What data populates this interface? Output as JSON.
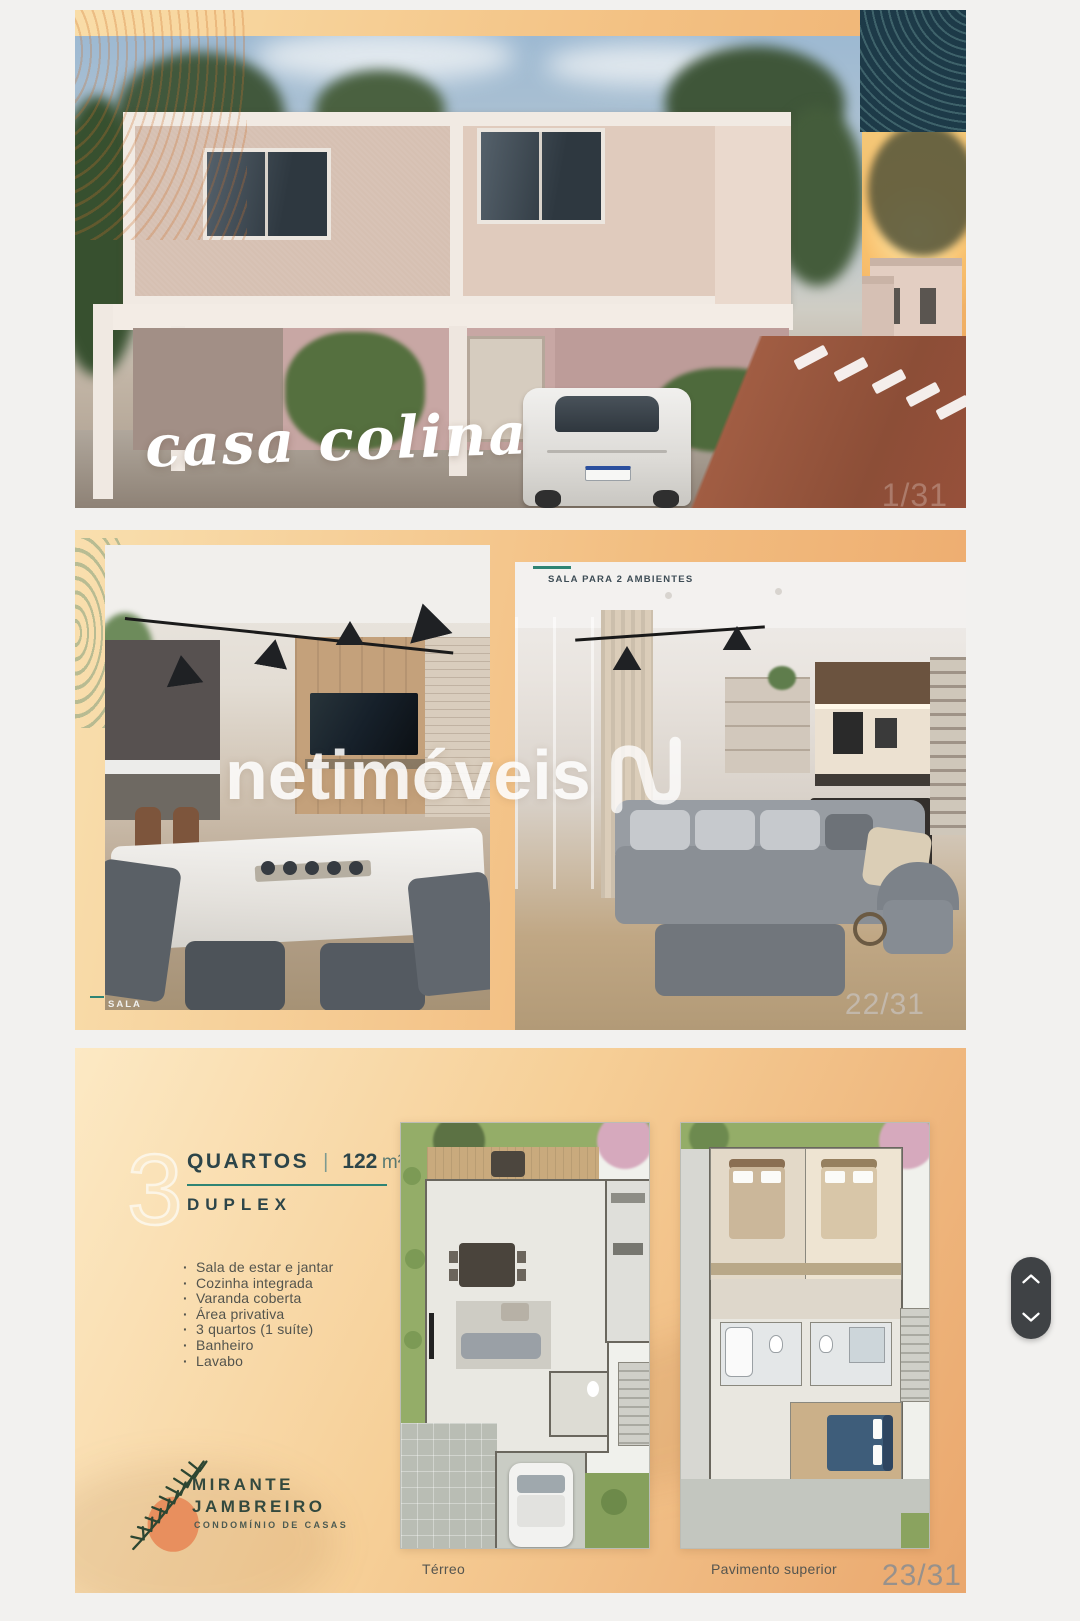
{
  "slides": {
    "cover": {
      "script_title": "casa colina",
      "page_indicator": "1/31"
    },
    "interiors": {
      "right_label": "SALA PARA 2 AMBIENTES",
      "left_label": "SALA",
      "watermark_text": "netimóveis",
      "page_indicator": "22/31"
    },
    "floorplan": {
      "big_number": "3",
      "rooms_word": "QUARTOS",
      "separator": "|",
      "area_number": "122",
      "area_unit": "m²",
      "subtype": "DUPLEX",
      "features": [
        "Sala de estar e jantar",
        "Cozinha integrada",
        "Varanda coberta",
        "Área privativa",
        "3 quartos (1 suíte)",
        "Banheiro",
        "Lavabo"
      ],
      "brand": {
        "name_line1": "MIRANTE",
        "name_line2": "JAMBREIRO",
        "tagline": "CONDOMÍNIO DE CASAS"
      },
      "plan_labels": {
        "left": "Térreo",
        "right": "Pavimento superior"
      },
      "page_indicator": "23/31"
    }
  },
  "colors": {
    "accent_teal": "#2f8474",
    "dark_slate": "#2d4549",
    "contour_navy": "#1d3a48",
    "logo_green": "#2d4632",
    "logo_orange": "#e88f5e",
    "nav_pill": "#3f4245"
  }
}
